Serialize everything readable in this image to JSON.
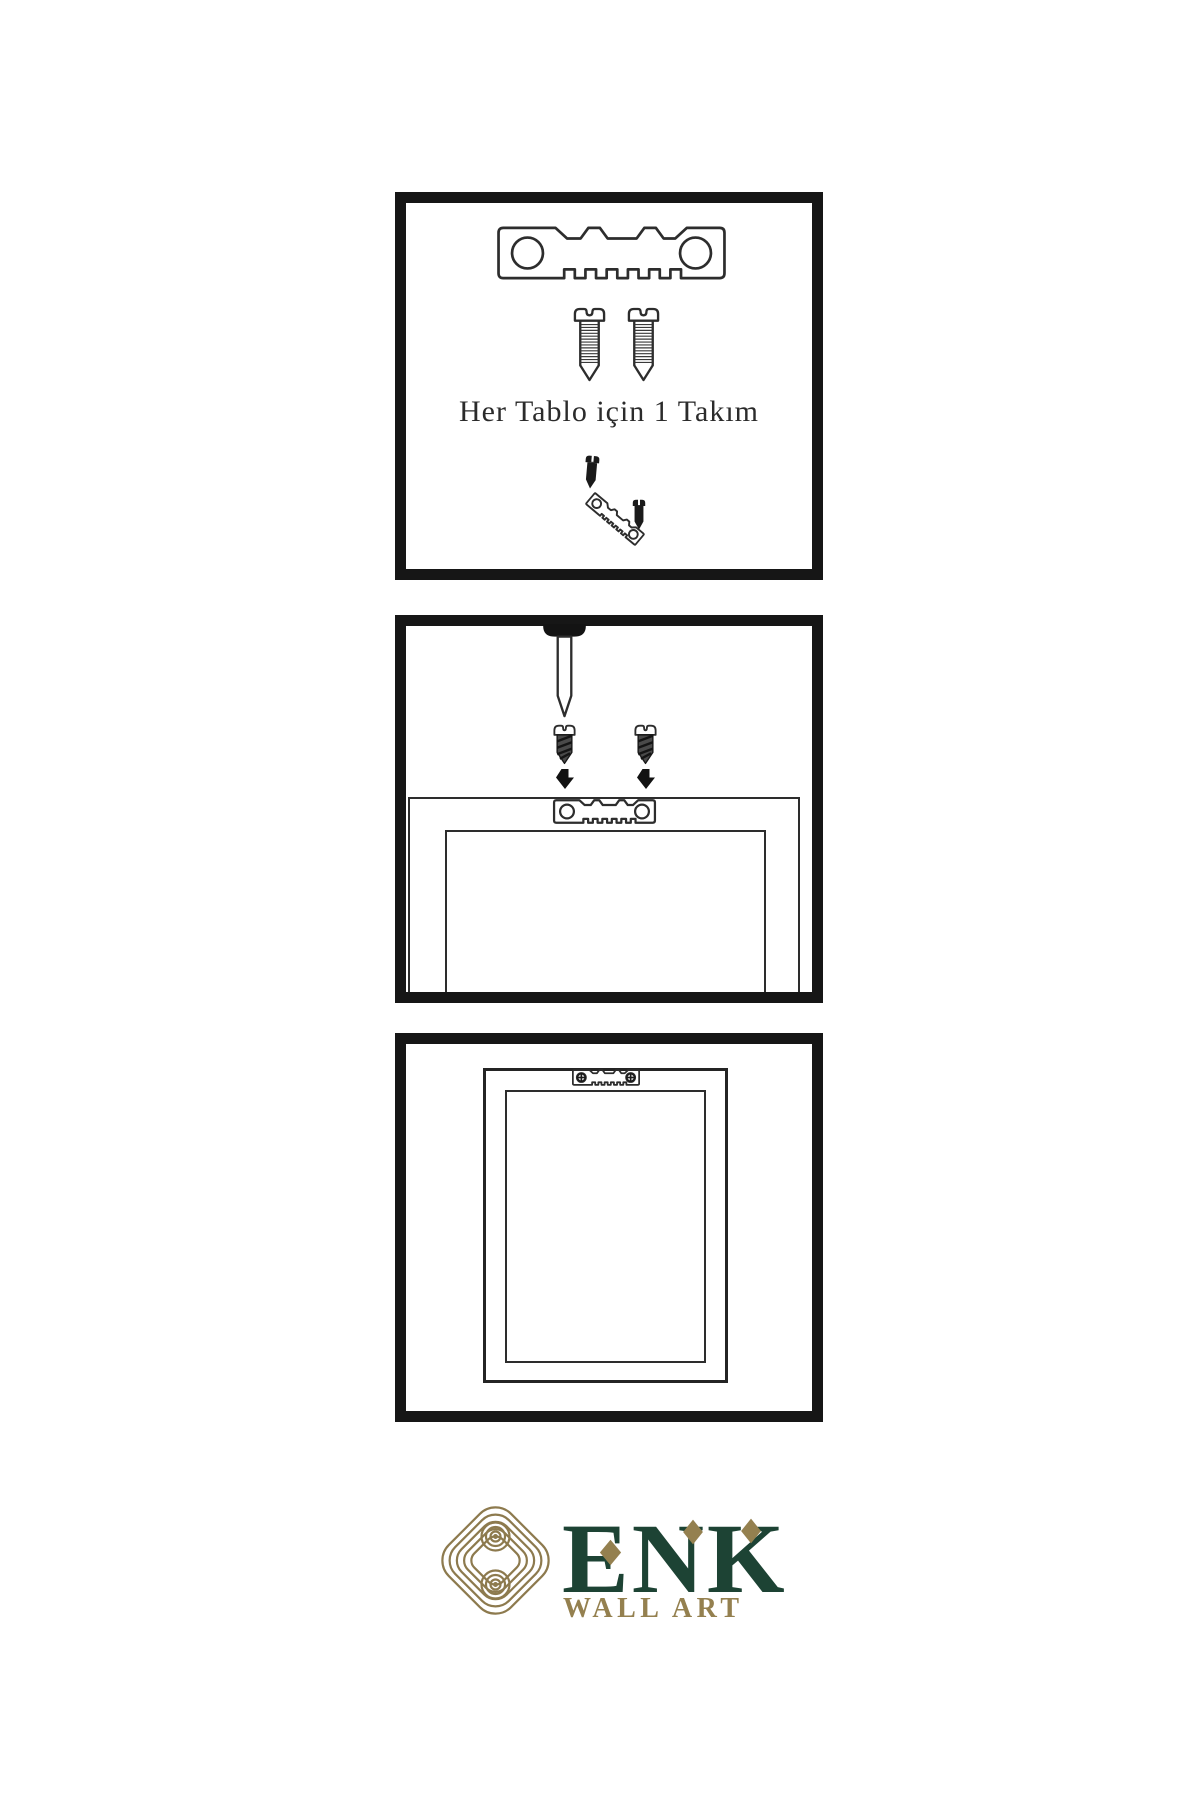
{
  "background": "#ffffff",
  "colors": {
    "panel_border": "#161616",
    "line_art": "#2d2d2d",
    "metal_dark": "#1a1a1a",
    "brand_green": "#1d4334",
    "brand_gold": "#94804f",
    "knot_gold": "#8d7a4e"
  },
  "panels": [
    {
      "id": "hardware-kit",
      "caption": "Her Tablo için 1 Takım",
      "items": [
        "sawtooth-hanger-icon",
        "screw-icon",
        "screw-icon",
        "dark-screw-icon",
        "tilted-sawtooth-hanger-icon",
        "dark-screw-icon"
      ]
    },
    {
      "id": "mount-hanger-to-frame",
      "items": [
        "nail-icon",
        "threaded-screw-icon",
        "threaded-screw-icon",
        "down-arrow-icon",
        "down-arrow-icon",
        "frame-back-outline",
        "sawtooth-hanger-icon"
      ]
    },
    {
      "id": "frame-hung-on-wall",
      "items": [
        "frame-front-outline",
        "mounted-sawtooth-hanger-icon"
      ]
    }
  ],
  "brand": {
    "name": "ENK",
    "subtitle": "WALL ART",
    "logo": "interlocked-knot"
  }
}
